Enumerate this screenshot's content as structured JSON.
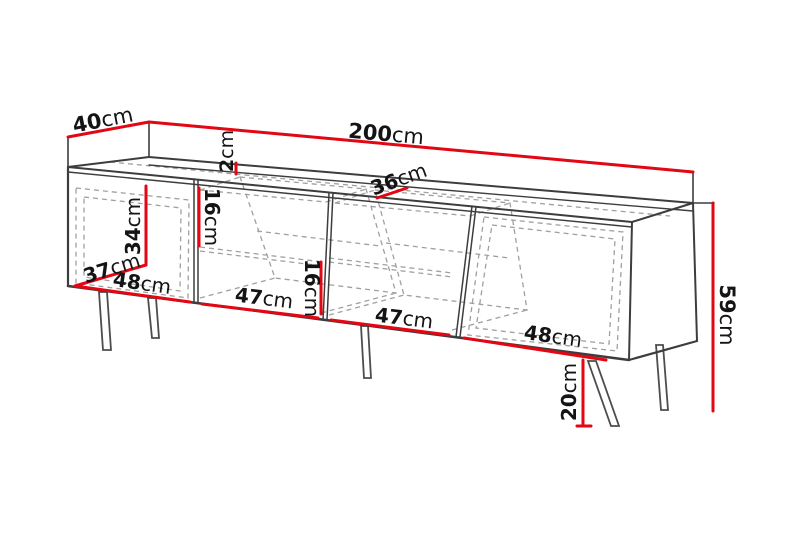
{
  "diagram": {
    "type": "furniture-dimension-drawing",
    "subject": "tv-stand-sideboard",
    "colors": {
      "dimension_line": "#e30613",
      "outline": "#3d3d3d",
      "hidden_line": "#a0a0a0",
      "text": "#141414",
      "background": "#ffffff"
    },
    "dimensions": {
      "total_width": {
        "value": "200",
        "unit": "cm"
      },
      "total_depth": {
        "value": "40",
        "unit": "cm"
      },
      "top_panel_thickness": {
        "value": "2",
        "unit": "cm"
      },
      "open_section_depth": {
        "value": "36",
        "unit": "cm"
      },
      "door_inner_height": {
        "value": "34",
        "unit": "cm"
      },
      "door_inner_depth": {
        "value": "37",
        "unit": "cm"
      },
      "left_section_width": {
        "value": "48",
        "unit": "cm"
      },
      "shelf_opening_left": {
        "value": "16",
        "unit": "cm"
      },
      "open_section_width_l": {
        "value": "47",
        "unit": "cm"
      },
      "shelf_opening_right": {
        "value": "16",
        "unit": "cm"
      },
      "open_section_width_r": {
        "value": "47",
        "unit": "cm"
      },
      "right_section_width": {
        "value": "48",
        "unit": "cm"
      },
      "total_height": {
        "value": "59",
        "unit": "cm"
      },
      "leg_height": {
        "value": "20",
        "unit": "cm"
      }
    }
  }
}
